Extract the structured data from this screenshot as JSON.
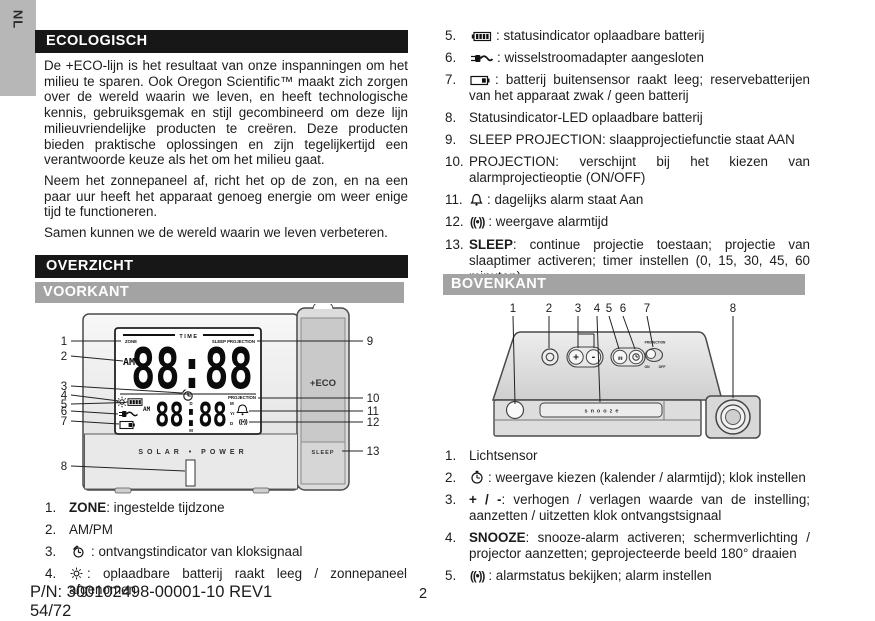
{
  "page": {
    "language_tab": "NL",
    "page_number": "2",
    "part_number": "P/N: 300102498-00001-10 REV1",
    "sheet": "54/72"
  },
  "sections": {
    "ecologisch": {
      "title": "ECOLOGISCH",
      "paragraphs": [
        "De +ECO-lijn is het resultaat van onze inspanningen om het milieu te sparen.  Ook Oregon Scientific™ maakt zich zorgen over de wereld waarin we leven, en heeft technologische kennis, gebruiksgemak en stijl gecombineerd om deze lijn milieuvriendelijke producten te creëren.   Deze producten bieden praktische oplossingen en zijn tegelijkertijd een verantwoorde keuze als het om het milieu gaat.",
        "Neem het zonnepaneel af, richt het op de zon, en na een paar uur heeft het apparaat genoeg energie om weer enige tijd te functioneren.",
        "Samen kunnen we de wereld waarin we leven verbeteren."
      ]
    },
    "overzicht": {
      "title": "OVERZICHT"
    },
    "voorkant": {
      "title": "VOORKANT"
    },
    "bovenkant": {
      "title": "BOVENKANT"
    }
  },
  "front_list": {
    "items": [
      {
        "num": "1.",
        "lead": "ZONE",
        "text": ": ingestelde tijdzone"
      },
      {
        "num": "2.",
        "text": "AM/PM"
      },
      {
        "num": "3.",
        "icon": "clock-signal-icon",
        "text": ": ontvangstindicator van kloksignaal"
      },
      {
        "num": "4.",
        "icon": "sun-icon",
        "text": ": oplaadbare batterij raakt leeg / zonnepaneel afgenomen"
      }
    ]
  },
  "display_list": {
    "items": [
      {
        "num": "5.",
        "icon": "battery-status-icon",
        "text": ": statusindicator oplaadbare batterij"
      },
      {
        "num": "6.",
        "icon": "ac-adapter-icon",
        "text": ": wisselstroomadapter aangesloten"
      },
      {
        "num": "7.",
        "icon": "battery-low-icon",
        "text": ": batterij buitensensor raakt leeg; reservebatterijen van het apparaat zwak / geen batterij"
      },
      {
        "num": "8.",
        "text": "Statusindicator-LED oplaadbare batterij"
      },
      {
        "num": "9.",
        "text": "SLEEP PROJECTION: slaapprojectiefunctie staat AAN"
      },
      {
        "num": "10.",
        "text": "PROJECTION: verschijnt bij het kiezen van alarmprojectieoptie (ON/OFF)"
      },
      {
        "num": "11.",
        "icon": "bell-icon",
        "text": ": dagelijks alarm staat Aan"
      },
      {
        "num": "12.",
        "icon": "alarm-time-icon",
        "text": ": weergave alarmtijd"
      },
      {
        "num": "13.",
        "lead": "SLEEP",
        "text": ": continue projectie toestaan; projectie van slaaptimer activeren; timer instellen (0, 15, 30, 45, 60 minuten)"
      }
    ]
  },
  "top_list": {
    "items": [
      {
        "num": "1.",
        "text": "Lichtsensor"
      },
      {
        "num": "2.",
        "icon": "clock-icon",
        "text": ": weergave kiezen (kalender / alarmtijd); klok instellen"
      },
      {
        "num": "3.",
        "lead": "+ / -",
        "text": ": verhogen / verlagen waarde van de instelling; aanzetten / uitzetten klok ontvangstsignaal"
      },
      {
        "num": "4.",
        "lead": "SNOOZE",
        "text": ": snooze-alarm activeren; schermverlichting / projector aanzetten; geprojecteerde beeld 180° draaien"
      },
      {
        "num": "5.",
        "icon": "alarm-time-icon",
        "text": ": alarmstatus bekijken; alarm instellen"
      }
    ]
  },
  "icons": {
    "alarm_glyph": "((•))"
  },
  "front_diagram": {
    "callouts": [
      "1",
      "2",
      "3",
      "4",
      "5",
      "6",
      "7",
      "8",
      "9",
      "10",
      "11",
      "12",
      "13"
    ],
    "lcd": {
      "time": "TIME",
      "zone": "ZONE",
      "sleep_projection": "SLEEP PROJECTION",
      "am": "AM",
      "digits": "88:88",
      "d": "D",
      "m": "M",
      "small_am": "AM",
      "small_digits": "88:88",
      "projection": "PROJECTION",
      "month": "M",
      "year": "Yr",
      "day": "D",
      "alarm_glyph": "((•))"
    },
    "solar_power": "SOLAR • POWER",
    "eco": "+ECO",
    "sleep": "SLEEP"
  },
  "top_diagram": {
    "callouts": [
      "1",
      "2",
      "3",
      "4",
      "5",
      "6",
      "7",
      "8"
    ],
    "snooze": "snooze",
    "projection": "PROJECTION",
    "on": "ON",
    "off": "OFF",
    "plus": "+",
    "minus": "-",
    "alarm_glyph": "((•))"
  }
}
